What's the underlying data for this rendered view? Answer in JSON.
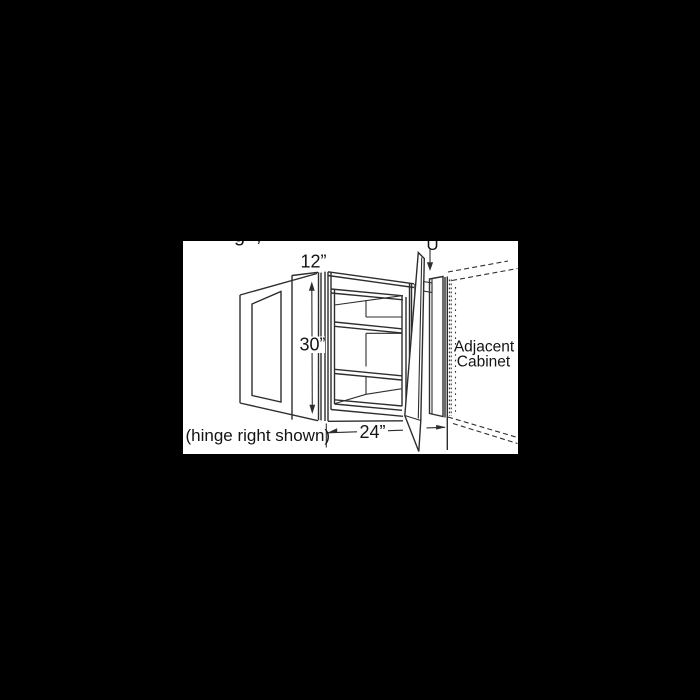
{
  "canvas": {
    "background": "#000000",
    "panel_background": "#ffffff",
    "line_color": "#2e2e2e"
  },
  "diagram": {
    "type": "cabinet-technical-line-drawing",
    "subject": "blind corner wall cabinet with open door, filler and adjacent cabinet",
    "labels": {
      "depth": "12”",
      "height": "30”",
      "width": "24”",
      "hinge_note": "(hinge right shown)",
      "adjacent_line1": "Adjacent",
      "adjacent_line2": "Cabinet"
    },
    "truncated_top_text": {
      "fragment_left": "g",
      "fragment_comma": ",",
      "fragment_right": "U"
    }
  }
}
